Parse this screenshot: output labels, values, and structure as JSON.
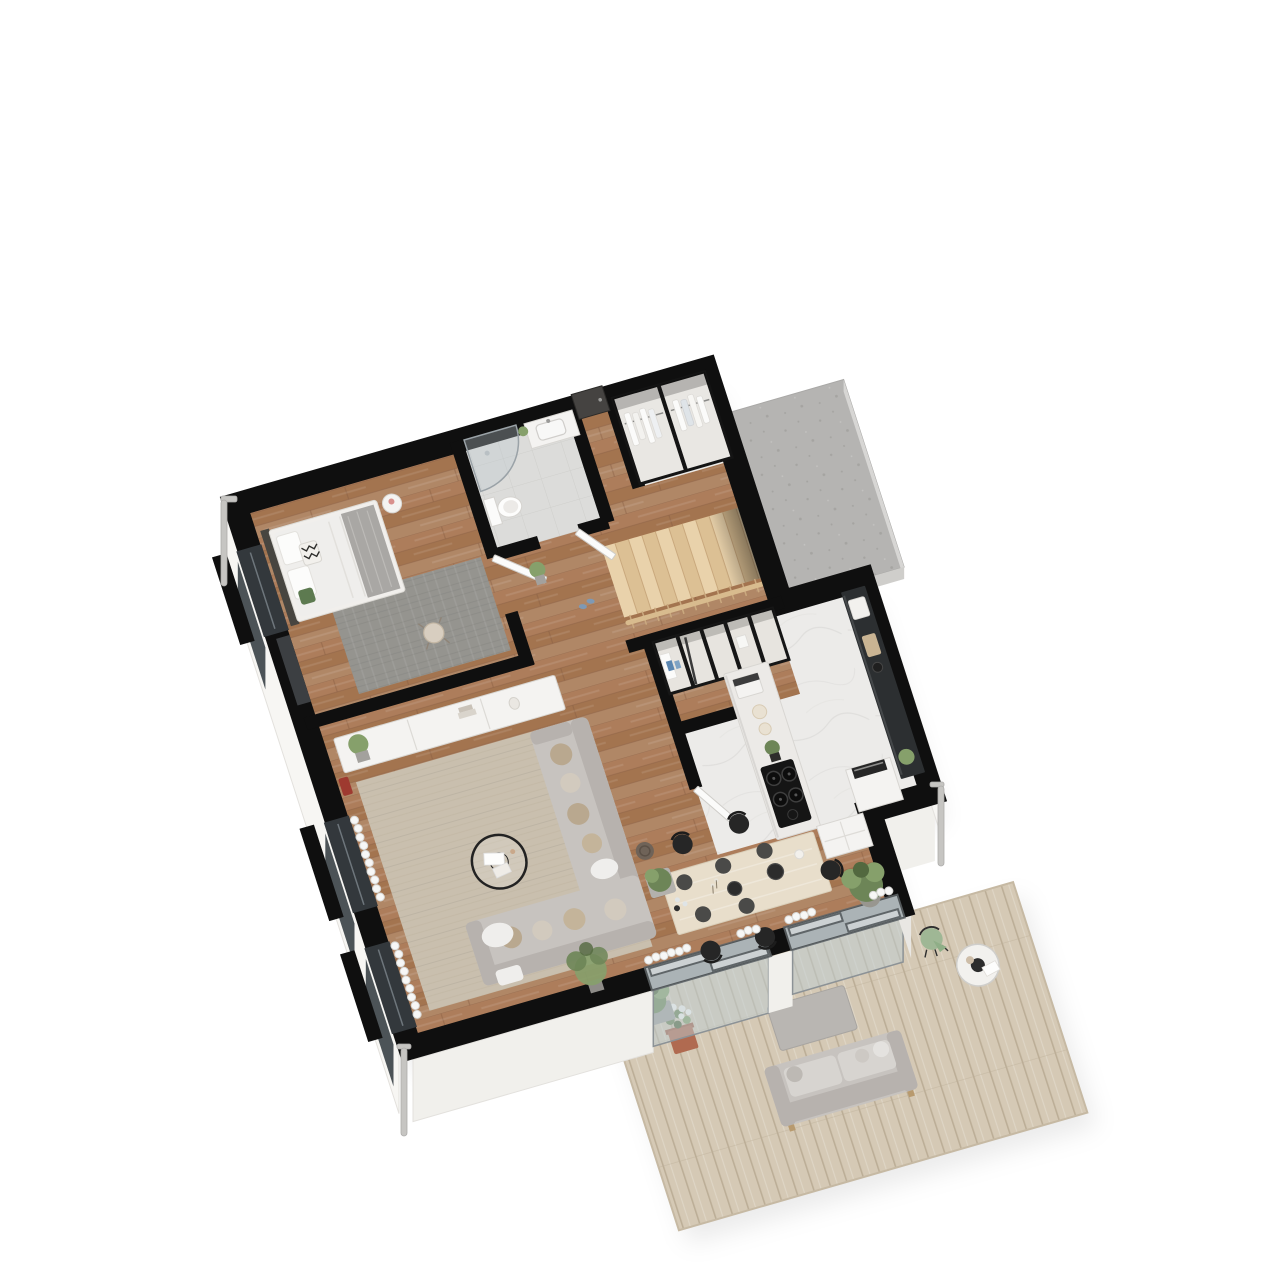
{
  "meta": {
    "type": "3d-floor-plan-render",
    "aria_label": "Axonometric 3D floor plan rendering of an apartment with terrace",
    "view": "axonometric top-down, rotated",
    "background": "#ffffff"
  },
  "palette": {
    "bg": "#ffffff",
    "wall": "#0f0f0f",
    "wallFaceWest": "#f7f6f3",
    "wallFaceSouth": "#f1f0ec",
    "wallFaceShade": "#e9e7e3",
    "woodA": "#ad7d5b",
    "woodB": "#a3744f",
    "woodC": "#b08766",
    "woodJoint": "#8a5f44",
    "marble": "#ecebe9",
    "marbleVein": "#dcdbd8",
    "tile": "#dcdcda",
    "tileLine": "#cfcfcc",
    "deck": "#d5c9b5",
    "deckLine": "#bcae97",
    "deckEdge": "#efeae0",
    "slab": "#b5b4b2",
    "slabDot": "#a5a4a1",
    "rugLiving": "#c9bfae",
    "rugLivingLine": "#beb3a0",
    "rugGray": "#95948f",
    "rugGrayLine": "#898883",
    "sofa": "#c7c3bf",
    "sofaDark": "#b7b2ae",
    "cushionA": "#b9a88f",
    "cushionB": "#d2cabe",
    "throw": "#efeeec",
    "tableWood": "#e8decb",
    "chairBlack": "#262626",
    "whiteFurn": "#f4f3f1",
    "whiteFurnStroke": "#d8d6d2",
    "counterDark": "#2c2f31",
    "cooktop": "#151515",
    "stair": "#e9d2ab",
    "stairDark": "#dcc094",
    "rail": "#d8bb8e",
    "railBaluster": "#caa97f",
    "greenA": "#6d8557",
    "greenB": "#86a06b",
    "greenC": "#52683f",
    "terracotta": "#b06a50",
    "planterGray": "#a3a19d",
    "glass": "#c7d0d4",
    "frame": "#5f6568",
    "windowDark": "#33383c",
    "curtain": "#f7f7f6",
    "curtainLine": "#d8d8d5",
    "accentRed": "#9e3a30",
    "pipe": "#c6c5c2",
    "bedBlanket": "#a9a7a4",
    "headboard": "#474540",
    "potPink": "#d8908c",
    "slipperBlue": "#7e99b5",
    "bottleBlue": "#5b86b0"
  },
  "scene": {
    "rooms": [
      {
        "name": "bedroom",
        "floor": "wood",
        "furniture": [
          "bed with white duvet and gray throw",
          "patterned pillow",
          "green cushion",
          "gray rug",
          "round side table with pink vase",
          "desk chair",
          "window bench"
        ]
      },
      {
        "name": "bathroom",
        "floor": "gray tile",
        "furniture": [
          "corner glass shower",
          "toilet",
          "vanity with basin",
          "green plant"
        ]
      },
      {
        "name": "entry-hall",
        "floor": "wood",
        "furniture": [
          "front door",
          "wardrobe with hanging clothes"
        ]
      },
      {
        "name": "hallway",
        "floor": "wood",
        "furniture": [
          "potted plant",
          "blue slippers",
          "open white doors"
        ]
      },
      {
        "name": "staircase",
        "floor": "light wood treads",
        "furniture": [
          "wood railing with balusters"
        ]
      },
      {
        "name": "storage-room",
        "floor": "wood",
        "furniture": [
          "open cubby shelving",
          "cleaning bottles",
          "broom",
          "towel"
        ]
      },
      {
        "name": "kitchen",
        "floor": "white marble",
        "furniture": [
          "island with black cooktop",
          "coffee machine",
          "plates",
          "plant",
          "dark wall counter",
          "oven tower",
          "base cabinet",
          "large potted tree"
        ]
      },
      {
        "name": "dining-area",
        "floor": "wood",
        "furniture": [
          "light wood dining table",
          "five black bentwood chairs",
          "dark placemats",
          "bowls",
          "candles"
        ]
      },
      {
        "name": "living-room",
        "floor": "wood",
        "furniture": [
          "beige rug",
          "L-shaped gray sofa with cushions",
          "white throw",
          "round black coffee table with books",
          "white sideboard with plant and decor",
          "red floor vase",
          "corner plant",
          "planter boxes",
          "wicker basket"
        ]
      },
      {
        "name": "terrace",
        "floor": "pale wood deck",
        "furniture": [
          "gray outdoor sofa",
          "gray coffee table",
          "round bistro table",
          "wire chair with green throw",
          "white flowers in terracotta pot",
          "bush in gray planter"
        ]
      }
    ],
    "exterior": [
      "white cut exterior walls with black wall tops",
      "three dark windows on west wall",
      "two sliding glass doors to terrace",
      "concrete entry slab at north-east",
      "downspout pipes at corners"
    ]
  }
}
